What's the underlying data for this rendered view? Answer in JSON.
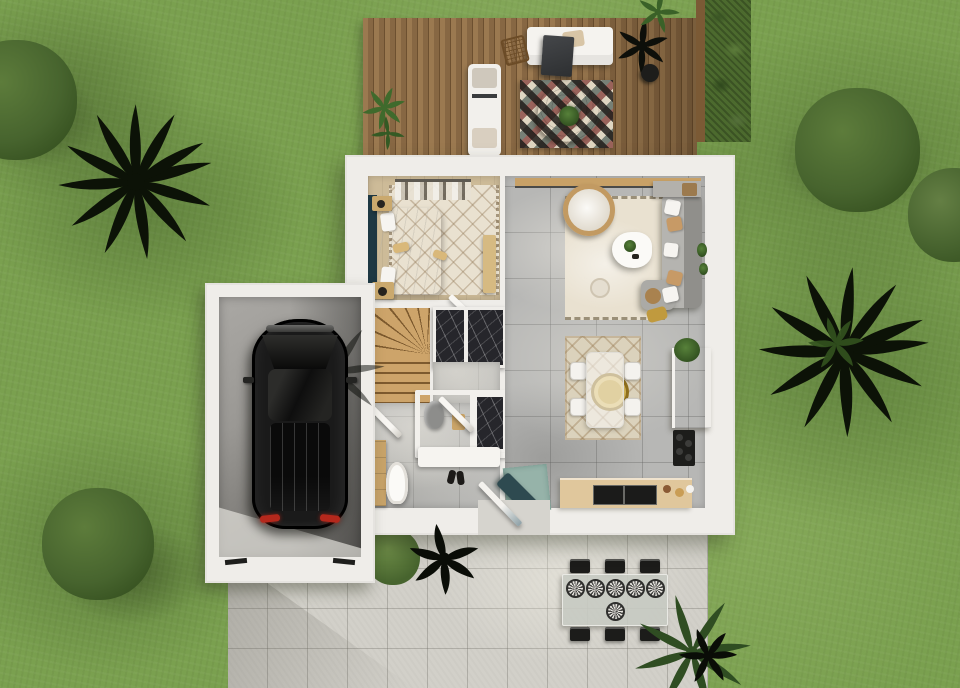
{
  "meta": {
    "description": "Top-down 3D architectural rendering of a single-storey house floor plan with garden, wooden deck terrace, attached garage with parked car, and concrete patio",
    "view": "top-down orthographic",
    "contains_text": false
  },
  "palette": {
    "grass-base": "#7aa04f",
    "grass-dark": "#5d8038",
    "grass-light": "#93b25f",
    "tree-dark": "#35501f",
    "tree-mid": "#4e6b31",
    "tree-light": "#5d7c3b",
    "palm-black": "#0c1207",
    "palm-green": "#33531f",
    "plant-green": "#3f6a2c",
    "deck-light": "#9b7950",
    "deck-mid": "#876743",
    "deck-line": "#6d5030",
    "wall-white": "#efede9",
    "wall-shade": "#d9d6cf",
    "tile-gray": "#b7b7b5",
    "tile-line": "#8f8f8d",
    "bedroom-floor": "#cdbb98",
    "rug-cream": "#e9e1d0",
    "rug-beige": "#dbd2bc",
    "stairs-wood": "#c59e63",
    "stairs-line": "#7d5a2e",
    "marble-dark": "#26262b",
    "teal-dark": "#1e3843",
    "mat-teal": "#96b3a9",
    "bench-teal": "#2e4a50",
    "sofa-gray": "#a2a19d",
    "counter-wood": "#e0c79c",
    "cabinet-wood": "#d9bf94",
    "gold": "#bf992a",
    "mustard": "#c09a3e",
    "car-black": "#1a1a1a",
    "taillight": "#b5281c",
    "patio-base": "#d2d0c9",
    "patio-line": "#b9b6ae",
    "garage-floor": "#a3a19d",
    "plate-dark": "#474745",
    "chair-black": "#1c1c1a",
    "rug-red": "#7e3030",
    "rug-teal": "#2f4a4a",
    "rug-sand": "#cfc2ac",
    "rug-black": "#211d1a",
    "wood-table": "#7a5630"
  },
  "scene": {
    "yard": {
      "ground": "lawn",
      "round_trees": 4,
      "palm_trees": 3,
      "hedge_strips": 1
    },
    "deck": {
      "material": "wood planks",
      "furniture": [
        "white outdoor sofa with dark throw",
        "beige cushion",
        "wire chair",
        "white lounge chair",
        "harlequin pattern rug",
        "organic wooden coffee table with plant",
        "black potted plant",
        "green potted plants"
      ]
    },
    "house": {
      "rooms": [
        {
          "name": "bedroom",
          "items": [
            "double bed",
            "cream lattice rug",
            "teal headboard wall",
            "clothes rack",
            "two nightstands",
            "wooden bench"
          ]
        },
        {
          "name": "living room",
          "items": [
            "gray corner sofa with cushions",
            "hanging rattan chair",
            "white coffee table with plant",
            "cream fringed rug",
            "curtain pelmet",
            "shelf with basket",
            "pouf"
          ]
        },
        {
          "name": "dining area",
          "items": [
            "glass dining table",
            "four white chairs",
            "gold round rug",
            "beige lattice rug"
          ]
        },
        {
          "name": "kitchen",
          "items": [
            "wood wall cabinet with plant",
            "black cooktop",
            "wood counter with black sink",
            "teal entry mat",
            "teal shoe bench"
          ]
        },
        {
          "name": "bathroom",
          "items": [
            "toilet cubicle",
            "gray toilet",
            "marble shower",
            "white vanity",
            "wooden cabinet",
            "second toilet",
            "shoes"
          ]
        },
        {
          "name": "staircase",
          "items": [
            "wooden winder stairs",
            "dark marble wardrobe"
          ]
        }
      ],
      "open_doors": 4
    },
    "garage": {
      "vehicle": "black car seen from above",
      "taillights": 2,
      "floor": "concrete with shadow"
    },
    "patio": {
      "material": "concrete pavers",
      "dining_set": {
        "chairs": 6,
        "plates": 6,
        "table": "glass-top outdoor table"
      },
      "plants": [
        "green bush",
        "black ornamental plant",
        "green palm",
        "black palm"
      ]
    }
  }
}
